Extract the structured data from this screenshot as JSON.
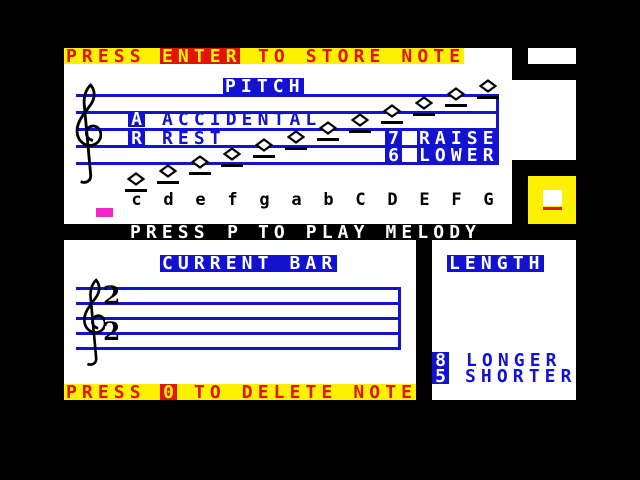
{
  "palette": {
    "blue": "#1212d0",
    "red": "#e01505",
    "yellow": "#fdf000",
    "magenta": "#f428c8",
    "white": "#ffffff",
    "black": "#000000"
  },
  "store_bar": {
    "prefix": "PRESS",
    "key": "ENTER",
    "suffix": "TO STORE NOTE"
  },
  "pitch": {
    "title": "PITCH",
    "keys": [
      {
        "key": "A",
        "label": "ACCIDENTAL"
      },
      {
        "key": "R",
        "label": "REST"
      },
      {
        "key": "7",
        "label": "RAISE"
      },
      {
        "key": "6",
        "label": "LOWER"
      }
    ],
    "note_letters": [
      "c",
      "d",
      "e",
      "f",
      "g",
      "a",
      "b",
      "C",
      "D",
      "E",
      "F",
      "G"
    ]
  },
  "play_bar": {
    "prefix": "PRESS",
    "key": "P",
    "suffix": "TO PLAY MELODY"
  },
  "current_bar": {
    "title": "CURRENT BAR",
    "time_signature_top": "2",
    "time_signature_bottom": "2"
  },
  "length": {
    "title": "LENGTH",
    "keys": [
      {
        "key": "8",
        "label": "LONGER"
      },
      {
        "key": "5",
        "label": "SHORTER"
      }
    ],
    "indicator": {
      "symbol": "square-note",
      "underline_color": "#e01505"
    }
  },
  "delete_bar": {
    "prefix": "PRESS",
    "key": "0",
    "suffix": "TO DELETE NOTE"
  }
}
